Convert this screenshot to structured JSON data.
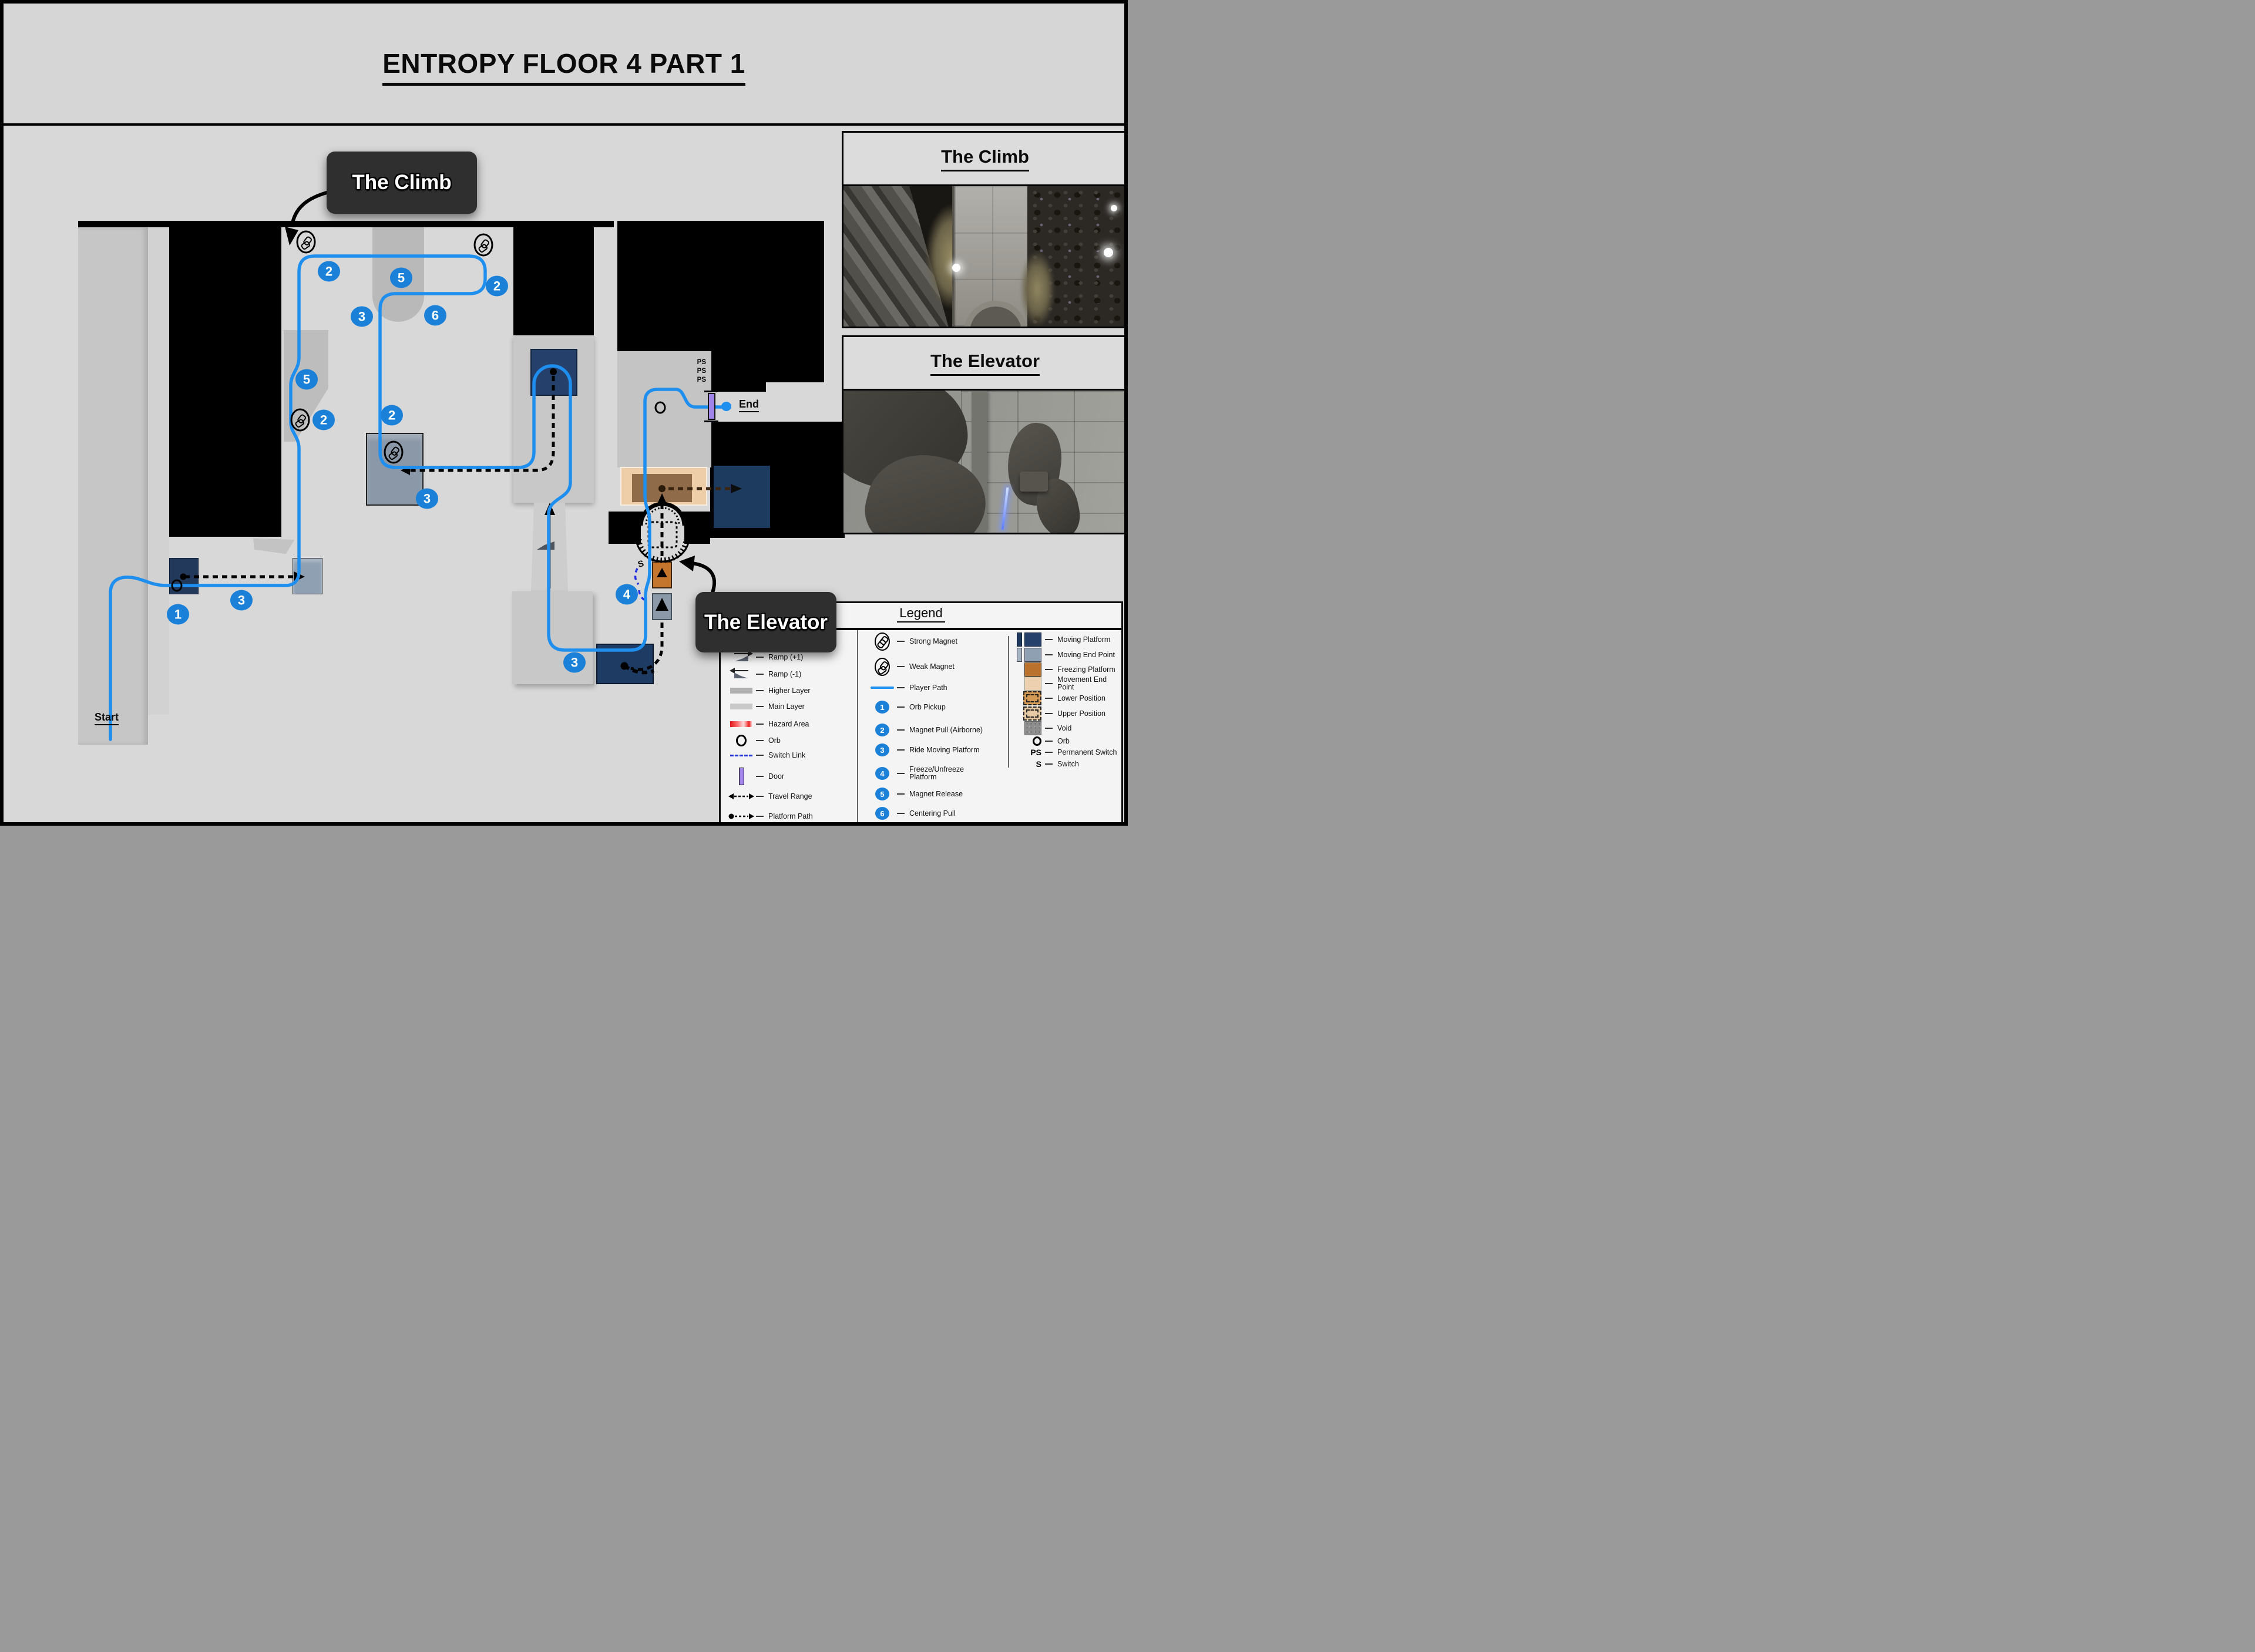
{
  "title": "ENTROPY FLOOR 4 PART 1",
  "map": {
    "start_label": "Start",
    "end_label": "End",
    "switch_label": "S",
    "ps": [
      "PS",
      "PS",
      "PS"
    ],
    "callouts": {
      "climb": "The Climb",
      "elevator": "The Elevator"
    },
    "badges": [
      "1",
      "3",
      "2",
      "5",
      "3",
      "6",
      "5",
      "2",
      "2",
      "2",
      "3",
      "3",
      "4"
    ]
  },
  "insets": [
    {
      "title": "The Climb"
    },
    {
      "title": "The Elevator"
    }
  ],
  "legend": {
    "title": "Legend",
    "col1": [
      {
        "label": "Wall"
      },
      {
        "label": "Ramp (+1)"
      },
      {
        "label": "Ramp (-1)"
      },
      {
        "label": "Higher Layer"
      },
      {
        "label": "Main Layer"
      },
      {
        "label": "Hazard Area"
      },
      {
        "label": "Orb"
      },
      {
        "label": "Switch Link"
      },
      {
        "label": "Door"
      },
      {
        "label": "Travel Range"
      },
      {
        "label": "Platform Path"
      }
    ],
    "col2": [
      {
        "label": "Strong Magnet"
      },
      {
        "label": "Weak Magnet"
      },
      {
        "label": "Player Path"
      },
      {
        "badge": "1",
        "label": "Orb Pickup"
      },
      {
        "badge": "2",
        "label": "Magnet Pull (Airborne)"
      },
      {
        "badge": "3",
        "label": "Ride Moving Platform"
      },
      {
        "badge": "4",
        "label": "Freeze/Unfreeze Platform"
      },
      {
        "badge": "5",
        "label": "Magnet Release"
      },
      {
        "badge": "6",
        "label": "Centering Pull"
      }
    ],
    "col3": [
      {
        "label": "Moving Platform"
      },
      {
        "label": "Moving End Point"
      },
      {
        "label": "Freezing Platform"
      },
      {
        "label": "Movement End Point"
      },
      {
        "label": "Lower Position"
      },
      {
        "label": "Upper Position"
      },
      {
        "label": "Void"
      },
      {
        "label": "Orb"
      },
      {
        "key": "PS",
        "label": "Permanent Switch"
      },
      {
        "key": "S",
        "label": "Switch"
      }
    ]
  },
  "colors": {
    "badge_blue": "#1a80d8",
    "player_path_blue": "#1f8fef",
    "door_purple": "#a184ea",
    "freezing_orange": "#b9712c",
    "moving_platform_navy": "#24406b",
    "moving_end_steel": "#8fa0b2",
    "movement_end_tan": "#edd0b0",
    "hazard_red": "#e01414"
  }
}
